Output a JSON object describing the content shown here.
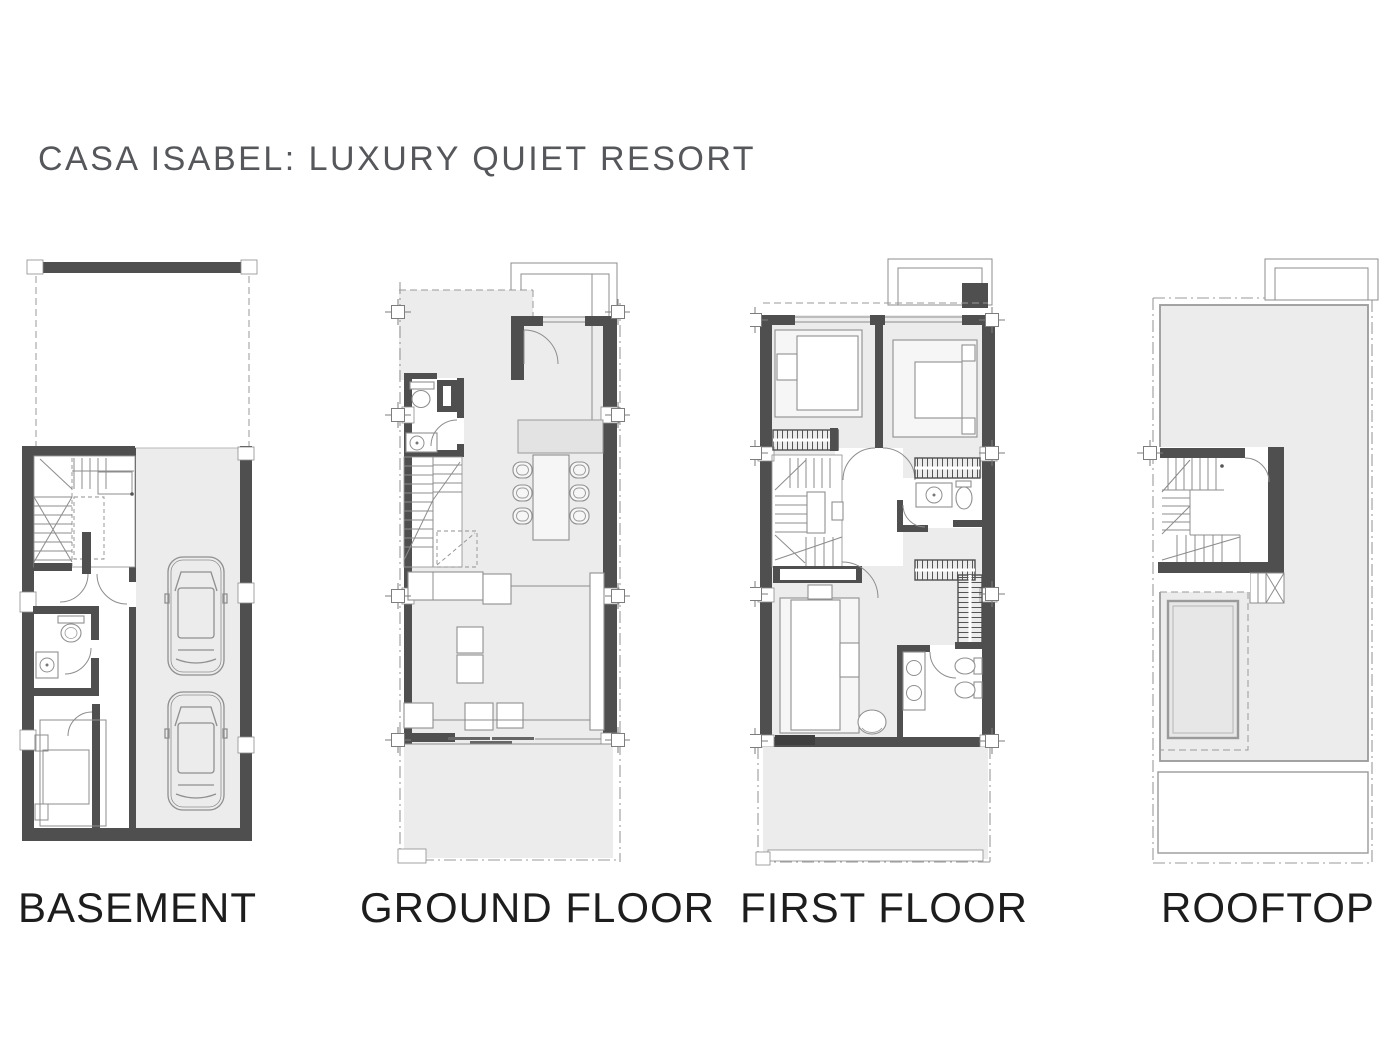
{
  "page": {
    "title": "CASA ISABEL: LUXURY QUIET RESORT",
    "background": "#ffffff"
  },
  "palette": {
    "wall": "#4f4f4f",
    "floor": "#ececec",
    "line": "#8c8c8c",
    "label_color": "#1d1d1d",
    "title_color": "#55575a"
  },
  "floors": [
    {
      "id": "basement",
      "label": "BASEMENT"
    },
    {
      "id": "ground",
      "label": "GROUND FLOOR"
    },
    {
      "id": "first",
      "label": "FIRST FLOOR"
    },
    {
      "id": "rooftop",
      "label": "ROOFTOP"
    }
  ]
}
